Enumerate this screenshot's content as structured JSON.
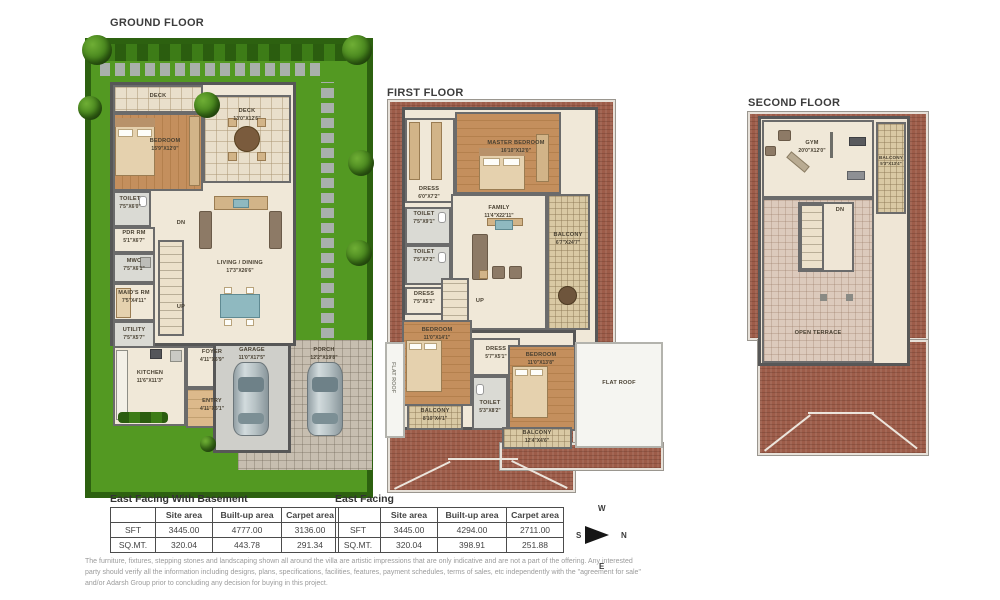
{
  "floors": {
    "ground": {
      "title": "GROUND FLOOR",
      "rooms": {
        "deck_top": {
          "name": "DECK",
          "dims": ""
        },
        "bedroom": {
          "name": "BEDROOM",
          "dims": "15'9\"X12'0\""
        },
        "deck_main": {
          "name": "DECK",
          "dims": "13'0\"X12'6\""
        },
        "toilet": {
          "name": "TOILET",
          "dims": "7'5\"X6'0\""
        },
        "pdr": {
          "name": "PDR RM",
          "dims": "5'1\"X6'7\""
        },
        "mwc": {
          "name": "MWC",
          "dims": "7'5\"X6'1\""
        },
        "maids": {
          "name": "MAID'S RM",
          "dims": "7'5\"X4'11\""
        },
        "utility": {
          "name": "UTILITY",
          "dims": "7'5\"X5'7\""
        },
        "living": {
          "name": "LIVING / DINING",
          "dims": "17'3\"X26'6\""
        },
        "foyer": {
          "name": "FOYER",
          "dims": "4'11\"X6'9\""
        },
        "kitchen": {
          "name": "KITCHEN",
          "dims": "11'6\"X11'3\""
        },
        "entry": {
          "name": "ENTRY",
          "dims": "4'11\"X5'1\""
        },
        "garage": {
          "name": "GARAGE",
          "dims": "11'0\"X17'5\""
        },
        "porch": {
          "name": "PORCH",
          "dims": "12'2\"X19'8\""
        },
        "dn": {
          "name": "DN",
          "dims": ""
        },
        "up": {
          "name": "UP",
          "dims": ""
        }
      }
    },
    "first": {
      "title": "FIRST FLOOR",
      "rooms": {
        "master": {
          "name": "MASTER BEDROOM",
          "dims": "16'10\"X12'0\""
        },
        "dress1": {
          "name": "DRESS",
          "dims": "6'0\"X7'2\""
        },
        "family": {
          "name": "FAMILY",
          "dims": "11'4\"X22'11\""
        },
        "toilet1": {
          "name": "TOILET",
          "dims": "7'5\"X9'1\""
        },
        "toilet2": {
          "name": "TOILET",
          "dims": "7'5\"X7'2\""
        },
        "balcony1": {
          "name": "BALCONY",
          "dims": "6'7\"X24'7\""
        },
        "dress2": {
          "name": "DRESS",
          "dims": "7'5\"X5'1\""
        },
        "up": {
          "name": "UP",
          "dims": ""
        },
        "bedroom2": {
          "name": "BEDROOM",
          "dims": "11'0\"X14'1\""
        },
        "dress3": {
          "name": "DRESS",
          "dims": "5'7\"X5'1\""
        },
        "bedroom3": {
          "name": "BEDROOM",
          "dims": "11'0\"X13'8\""
        },
        "toilet3": {
          "name": "TOILET",
          "dims": "5'3\"X8'2\""
        },
        "flatroof_left": {
          "name": "FLAT ROOF",
          "dims": ""
        },
        "flatroof_right": {
          "name": "FLAT ROOF",
          "dims": ""
        },
        "balcony2": {
          "name": "BALCONY",
          "dims": "8'10\"X4'1\""
        },
        "balcony3": {
          "name": "BALCONY",
          "dims": "12'4\"X4'6\""
        }
      }
    },
    "second": {
      "title": "SECOND FLOOR",
      "rooms": {
        "gym": {
          "name": "GYM",
          "dims": "20'0\"X12'0\""
        },
        "balcony": {
          "name": "BALCONY",
          "dims": "5'3\"X13'4\""
        },
        "dn": {
          "name": "DN",
          "dims": ""
        },
        "terrace": {
          "name": "OPEN TERRACE",
          "dims": ""
        }
      }
    }
  },
  "tables": [
    {
      "title": "East Facing With Basement",
      "headers": [
        "",
        "Site area",
        "Built-up area",
        "Carpet area"
      ],
      "rows": [
        [
          "SFT",
          "3445.00",
          "4777.00",
          "3136.00"
        ],
        [
          "SQ.MT.",
          "320.04",
          "443.78",
          "291.34"
        ]
      ]
    },
    {
      "title": "East Facing",
      "headers": [
        "",
        "Site area",
        "Built-up area",
        "Carpet area"
      ],
      "rows": [
        [
          "SFT",
          "3445.00",
          "4294.00",
          "2711.00"
        ],
        [
          "SQ.MT.",
          "320.04",
          "398.91",
          "251.88"
        ]
      ]
    }
  ],
  "compass": {
    "w": "W",
    "n": "N",
    "s": "S",
    "e": "E"
  },
  "disclaimer": "The furniture, fixtures, stepping stones and landscaping shown all around the villa are artistic impressions that are only indicative and are not a part of the offering. Any interested party should verify all the information including designs, plans, specifications, facilities, features, payment schedules, terms of sales, etc independently with the \"agreement for sale\" and/or Adarsh Group prior to concluding any decision for buying in this project."
}
